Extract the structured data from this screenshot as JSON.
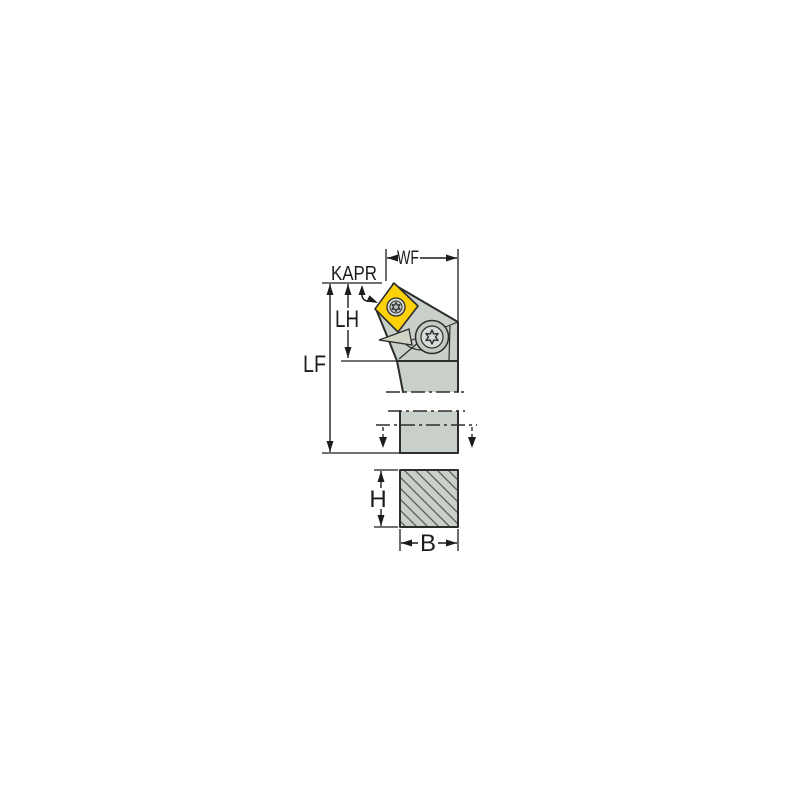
{
  "diagram": {
    "labels": {
      "wf": "WF",
      "kapr": "KAPR",
      "lh": "LH",
      "lf": "LF",
      "h": "H",
      "b": "B"
    },
    "colors": {
      "background": "#ffffff",
      "insert": "#fdd108",
      "body": "#c9cfc9",
      "body-light": "#d8dcd8",
      "body-dark": "#c3c9c3",
      "shim": "#d2d4c4",
      "outline": "#2d2d2d",
      "dim": "#1c1c1c",
      "hatch": "#565c56"
    }
  }
}
